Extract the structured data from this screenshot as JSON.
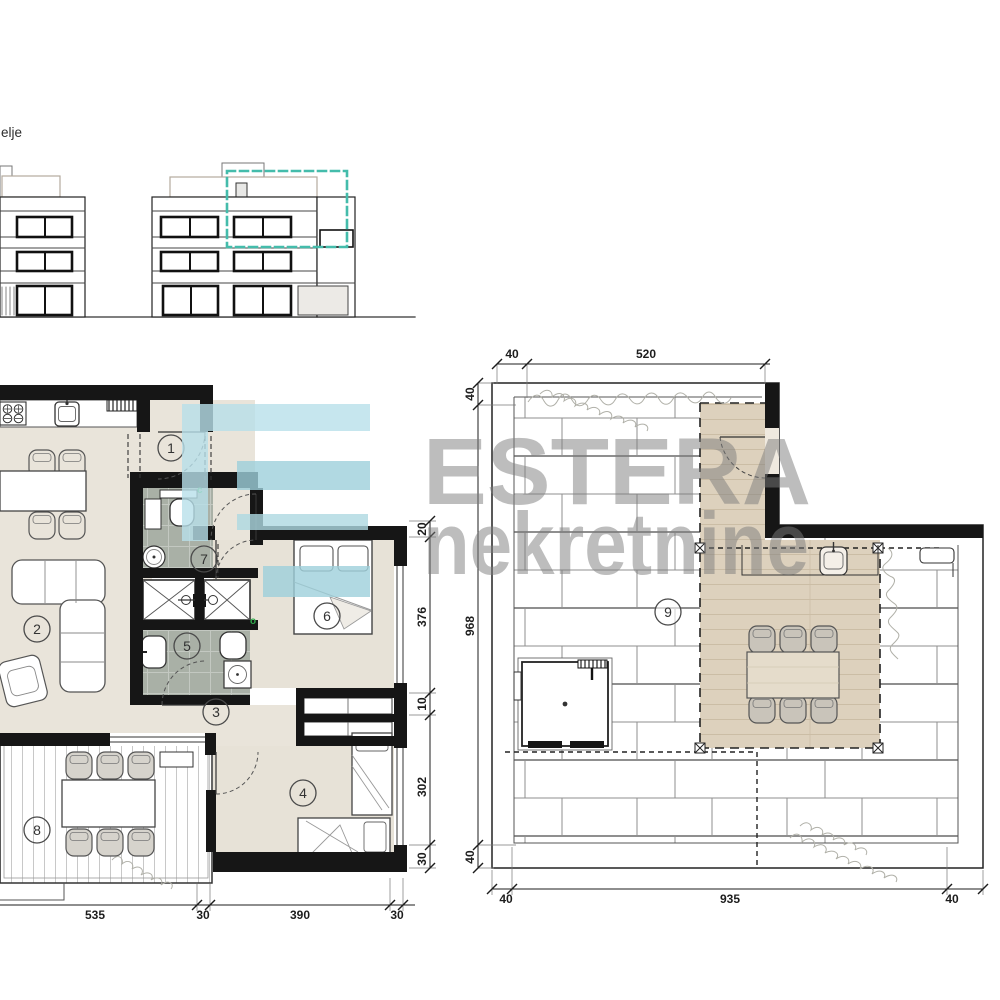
{
  "page": {
    "corner_text": "elje"
  },
  "watermark": {
    "brand": "ESTERA",
    "subtitle": "nekretnine"
  },
  "left_plan": {
    "rooms": {
      "r1": "1",
      "r2": "2",
      "r3": "3",
      "r4": "4",
      "r5": "5",
      "r6": "6",
      "r7": "7",
      "r8": "8"
    },
    "markers": {
      "m_c": "c",
      "m_o": "o"
    },
    "dims": {
      "right": {
        "a": "20",
        "b": "376",
        "c": "10",
        "d": "302",
        "e": "30"
      },
      "bottom": {
        "a": "535",
        "b": "30",
        "c": "390",
        "d": "30"
      }
    }
  },
  "right_plan": {
    "rooms": {
      "r9": "9"
    },
    "dims": {
      "top": {
        "a": "40",
        "b": "520"
      },
      "left": {
        "a": "40",
        "b": "968",
        "c": "40"
      },
      "bottom": {
        "a": "40",
        "b": "935",
        "c": "40"
      }
    }
  },
  "colors": {
    "highlight_teal": "#44bcab",
    "wall_black": "#161616",
    "floor_beige": "#e9e4da",
    "bath_gray": "#a9b0a6",
    "deck_wood": "#ddd1bd",
    "watermark_cyan_light": "#b8e0ea",
    "watermark_cyan_dark": "#9ed0db",
    "watermark_gray": "#7d7d7d"
  }
}
